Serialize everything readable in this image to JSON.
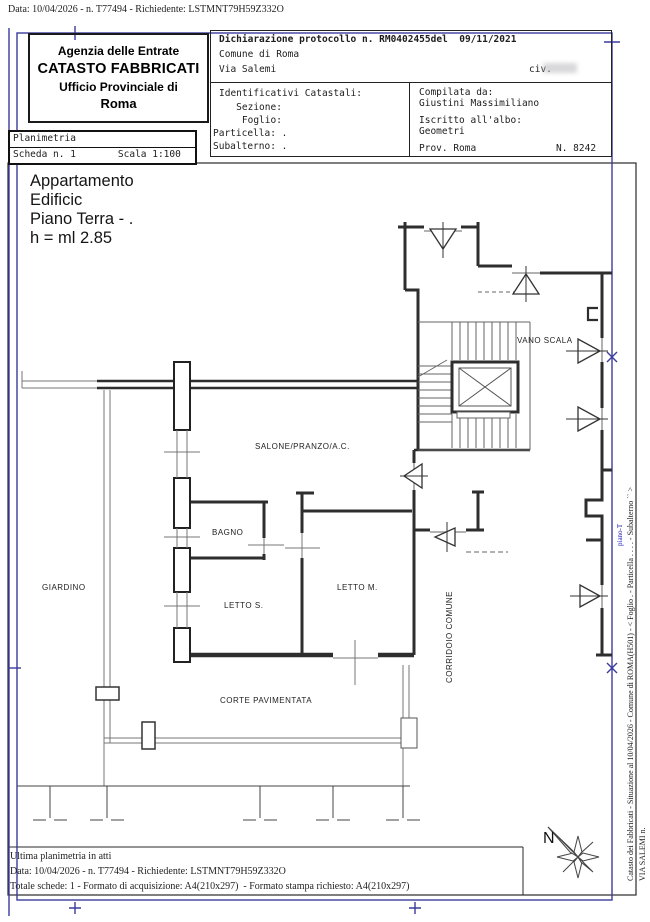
{
  "document": {
    "top_line": "Data: 10/04/2026 - n. T77494 - Richiedente: LSTMNT79H59Z332O"
  },
  "header": {
    "agency": {
      "line1": "Agenzia delle Entrate",
      "line2": "CATASTO FABBRICATI",
      "line3": "Ufficio Provinciale di",
      "line4": "Roma"
    },
    "planimetria": {
      "title": "Planimetria",
      "scheda": "Scheda n. 1",
      "scala": "Scala 1:100"
    },
    "declaration": {
      "protocollo": "Dichiarazione protocollo n. RM0402455del  09/11/2021",
      "comune": "Comune di Roma",
      "via": "Via Salemi",
      "civ": "civ.",
      "catastali_title": "Identificativi Catastali:",
      "sezione": "   Sezione:",
      "foglio": "    Foglio:",
      "particella": "Particella: .",
      "subalterno": "Subalterno: .",
      "compilata_title": "Compilata da:",
      "compilata_nome": "Giustini Massimiliano",
      "albo_label": "Iscritto all'albo:",
      "albo_value": "Geometri",
      "prov": "Prov. Roma",
      "numero": "N. 8242"
    }
  },
  "apartment": {
    "line1": "Appartamento",
    "line2": "Edificic",
    "line3": "Piano Terra - .",
    "line4": "h = ml 2.85"
  },
  "plan": {
    "labels": {
      "vano_scala": "VANO SCALA",
      "salone": "SALONE/PRANZO/A.C.",
      "bagno": "BAGNO",
      "letto_s": "LETTO S.",
      "letto_m": "LETTO M.",
      "giardino": "GIARDINO",
      "corte": "CORTE PAVIMENTATA",
      "corridoio": "CORRIDOIO COMUNE",
      "north": "N"
    }
  },
  "side_strip": {
    "catasto_line": "Catasto dei Fabbricati - Situazione al 10/04/2026 - Comune di ROMA(H501) - < Foglio . - Particella . . . . - Subalterno `` >",
    "via_line": "VIA SALEMI n.",
    "blue_note": "piano-T"
  },
  "footer": {
    "ultima": "Ultima planimetria in atti",
    "data_line": "Data: 10/04/2026 - n. T77494 - Richiedente: LSTMNT79H59Z332O",
    "totale": "Totale schede: 1 - Formato di acquisizione: A4(210x297)  - Formato stampa richiesto: A4(210x297)"
  },
  "colors": {
    "border_blue": "#3b3b9e",
    "wall": "#2e2e2e",
    "accent_blue": "#2323bb"
  }
}
